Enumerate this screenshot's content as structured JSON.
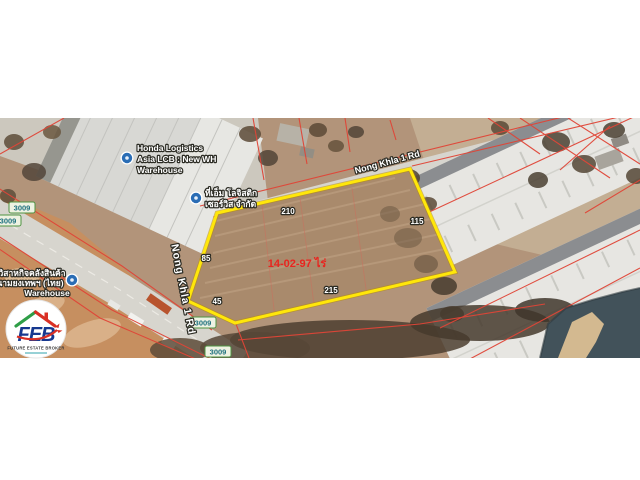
{
  "map": {
    "plot": {
      "area_label": "14-02-97 ไร่",
      "area_color": "#e8251f",
      "outline_color": "#ffe70a",
      "side_lengths": {
        "top": "210",
        "right": "115",
        "bottom": "215",
        "left": "85",
        "bottom_left": "45"
      }
    },
    "roads": {
      "diagonal_label": "Nong Khla 1 Rd",
      "vertical_label": "Nong Khla 1 Rd",
      "route_badge": "3009"
    },
    "places": {
      "honda": {
        "line1": "Honda Logistics",
        "line2": "Asia LCB : New WH",
        "line3": "Warehouse"
      },
      "tm_logistic": {
        "line1": "ที่เอ็ม โลจิสติก",
        "line2": "เซอร์วิส จำกัด"
      },
      "namyong": {
        "line1": "วิสาหกิจคลังสินค้า",
        "line2": "นามยงเทพฯ (ไทย)",
        "line3": "Warehouse"
      }
    },
    "marker_color": "#2a6db5",
    "badge_colors": {
      "border": "#4f9443",
      "text": "#1b6f7e",
      "fill": "#eef2e2"
    }
  },
  "logo": {
    "acronym": "FEB",
    "tagline": "FUTURE ESTATE BROKER",
    "colors": {
      "blue": "#16388f",
      "red": "#d93025",
      "green": "#2f9e47"
    }
  }
}
